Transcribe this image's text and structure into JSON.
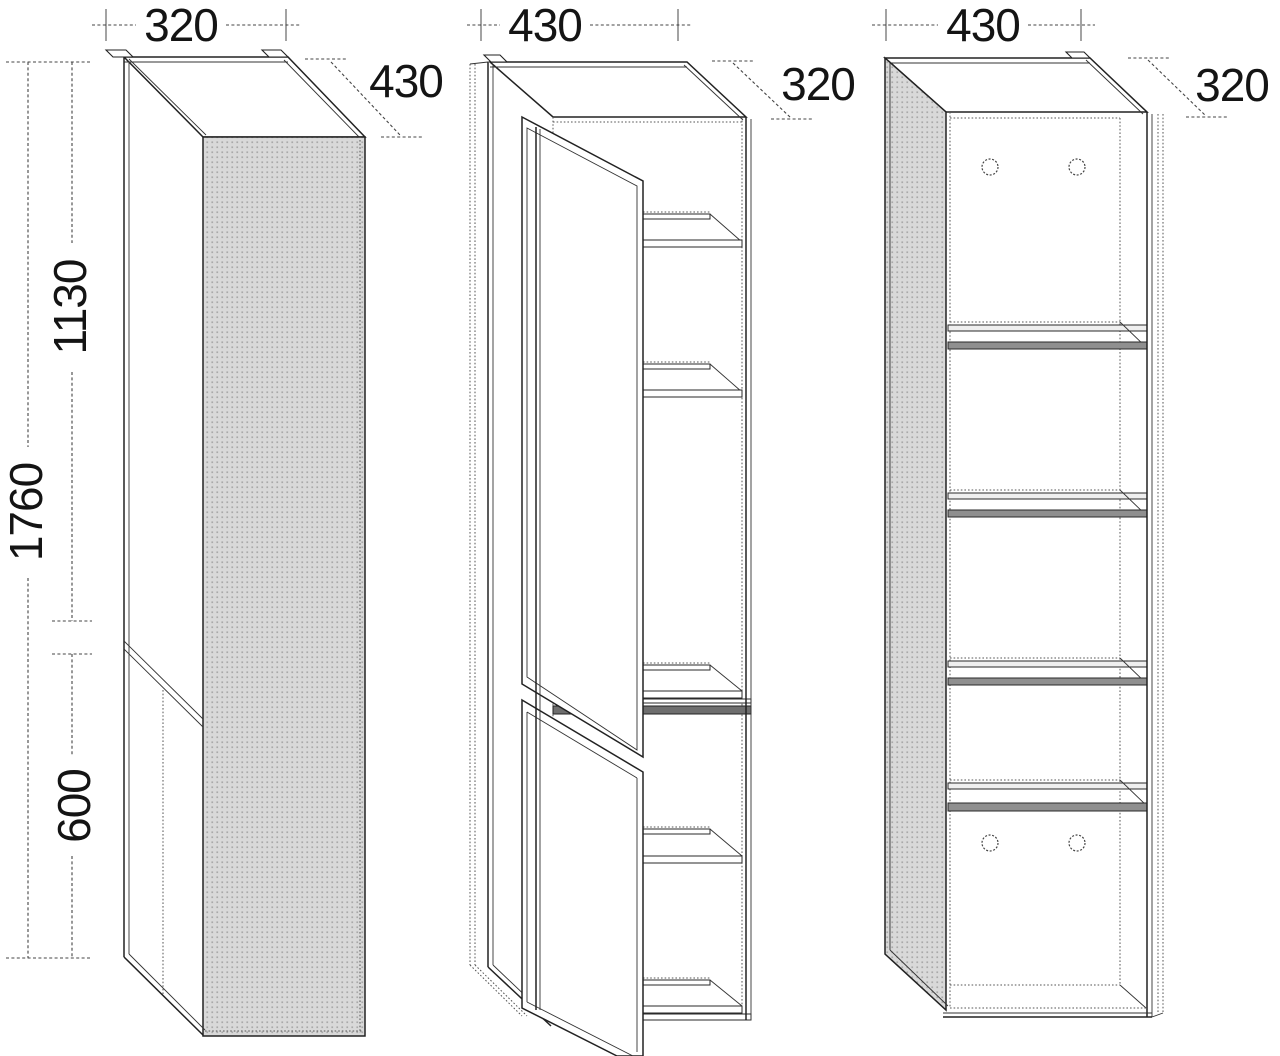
{
  "drawing_type": "furniture-dimension-diagram",
  "colors": {
    "background": "#ffffff",
    "line": "#222222",
    "panel_fill": "#d9d9d9",
    "panel_dot": "#a9a9a9",
    "shelf_dark": "#8f8f8f",
    "divider": "#6e6e6e"
  },
  "views": {
    "closed": {
      "width": "320",
      "depth": "430",
      "height_total": "1760",
      "height_upper": "1130",
      "height_lower": "600"
    },
    "open_doors": {
      "width": "430",
      "depth": "320"
    },
    "open_shelves": {
      "width": "430",
      "depth": "320"
    }
  }
}
